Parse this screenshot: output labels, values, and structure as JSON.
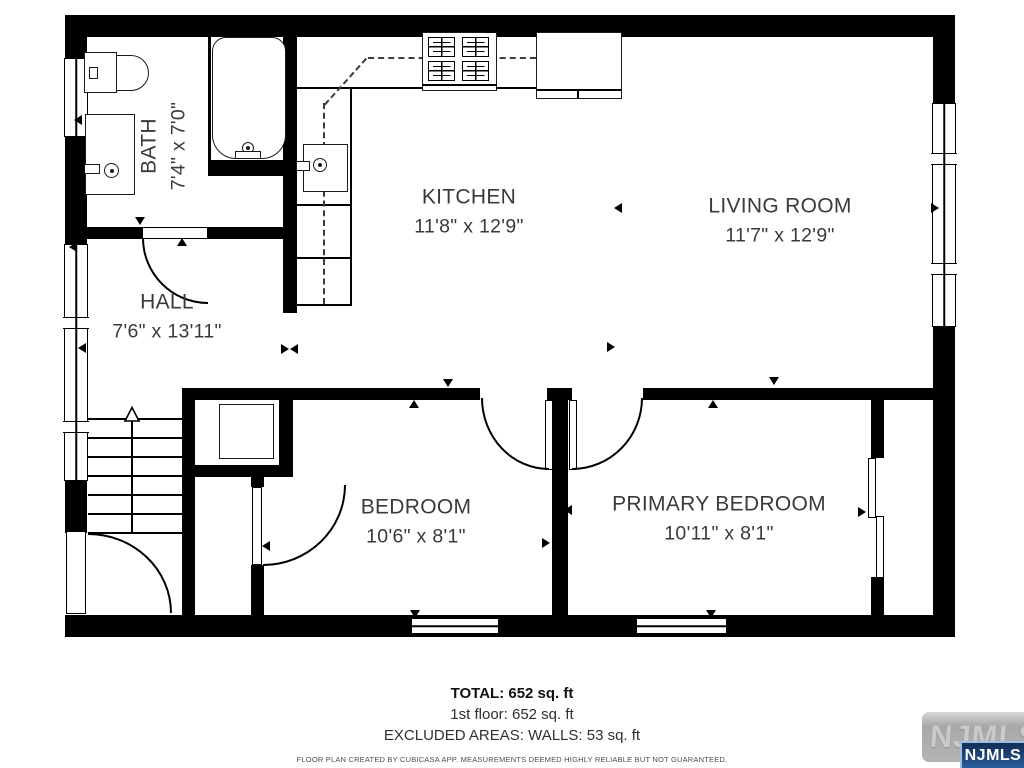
{
  "rooms": [
    {
      "id": "bath",
      "name": "BATH",
      "dims": "7'4\" x 7'0\""
    },
    {
      "id": "kitchen",
      "name": "KITCHEN",
      "dims": "11'8\" x 12'9\""
    },
    {
      "id": "living",
      "name": "LIVING ROOM",
      "dims": "11'7\" x 12'9\""
    },
    {
      "id": "hall",
      "name": "HALL",
      "dims": "7'6\" x 13'11\""
    },
    {
      "id": "bedroom",
      "name": "BEDROOM",
      "dims": "10'6\" x 8'1\""
    },
    {
      "id": "primary",
      "name": "PRIMARY BEDROOM",
      "dims": "10'11\" x 8'1\""
    }
  ],
  "summary": {
    "total": "TOTAL: 652 sq. ft",
    "floor": "1st floor: 652 sq. ft",
    "excluded": "EXCLUDED AREAS: WALLS: 53 sq. ft"
  },
  "disclaimer": "FLOOR PLAN CREATED BY CUBICASA APP. MEASUREMENTS DEEMED HIGHLY RELIABLE BUT NOT GUARANTEED.",
  "watermark": {
    "background_text": "NJMLS",
    "badge_text": "NJMLS"
  },
  "colors": {
    "wall": "#000000",
    "label_text": "#3a3a3a",
    "badge_blue": "#1d4679",
    "watermark_gray": "#adadad"
  }
}
